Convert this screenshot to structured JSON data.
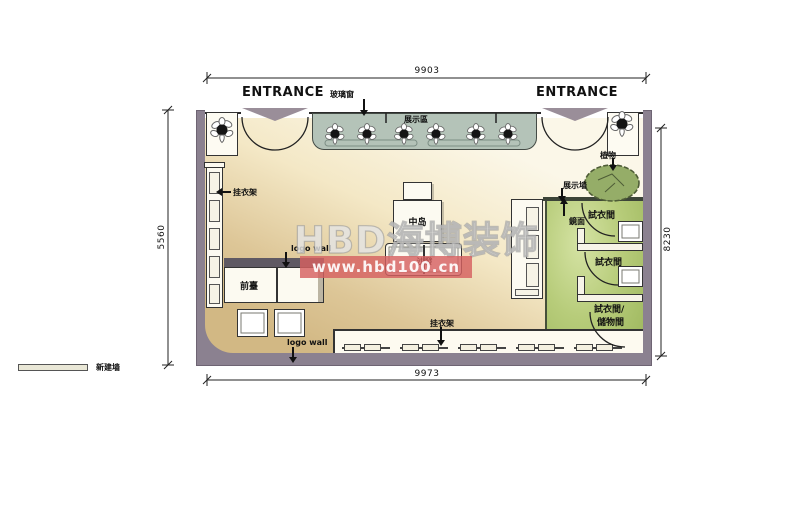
{
  "watermark": {
    "brand": "HBD海博装饰",
    "url": "www.hbd100.cn"
  },
  "entrances": {
    "left": "ENTRANCE",
    "right": "ENTRANCE"
  },
  "dimensions": {
    "top": "9903",
    "bottom": "9973",
    "left": "5560",
    "right": "8230"
  },
  "areas": {
    "display_window": "展示區",
    "fitting_room_1": "試衣間",
    "fitting_room_2": "試衣間",
    "fitting_room_3_line1": "試衣間/",
    "fitting_room_3_line2": "儲物間"
  },
  "furniture": {
    "front_desk": "前臺",
    "center_island": "中岛",
    "sofa": "沙發"
  },
  "callouts": {
    "glass_window": "玻璃窗",
    "plant": "植物",
    "display_wall": "展示墙",
    "mirror": "鏡面",
    "rack_left": "挂衣架",
    "rack_bottom": "挂衣架",
    "logo_wall_left": "logo wall",
    "logo_wall_bottom": "logo wall"
  },
  "legend": {
    "new_wall": "新建墙"
  },
  "colors": {
    "wall": "#8b8190",
    "floor_light": "#fbf7e8",
    "floor_tan": "#d2b884",
    "display_band": "#b4c3b8",
    "fitting_green": "#b7cc7a",
    "watermark_pink": "#d96262",
    "line": "#2b2b2b"
  }
}
